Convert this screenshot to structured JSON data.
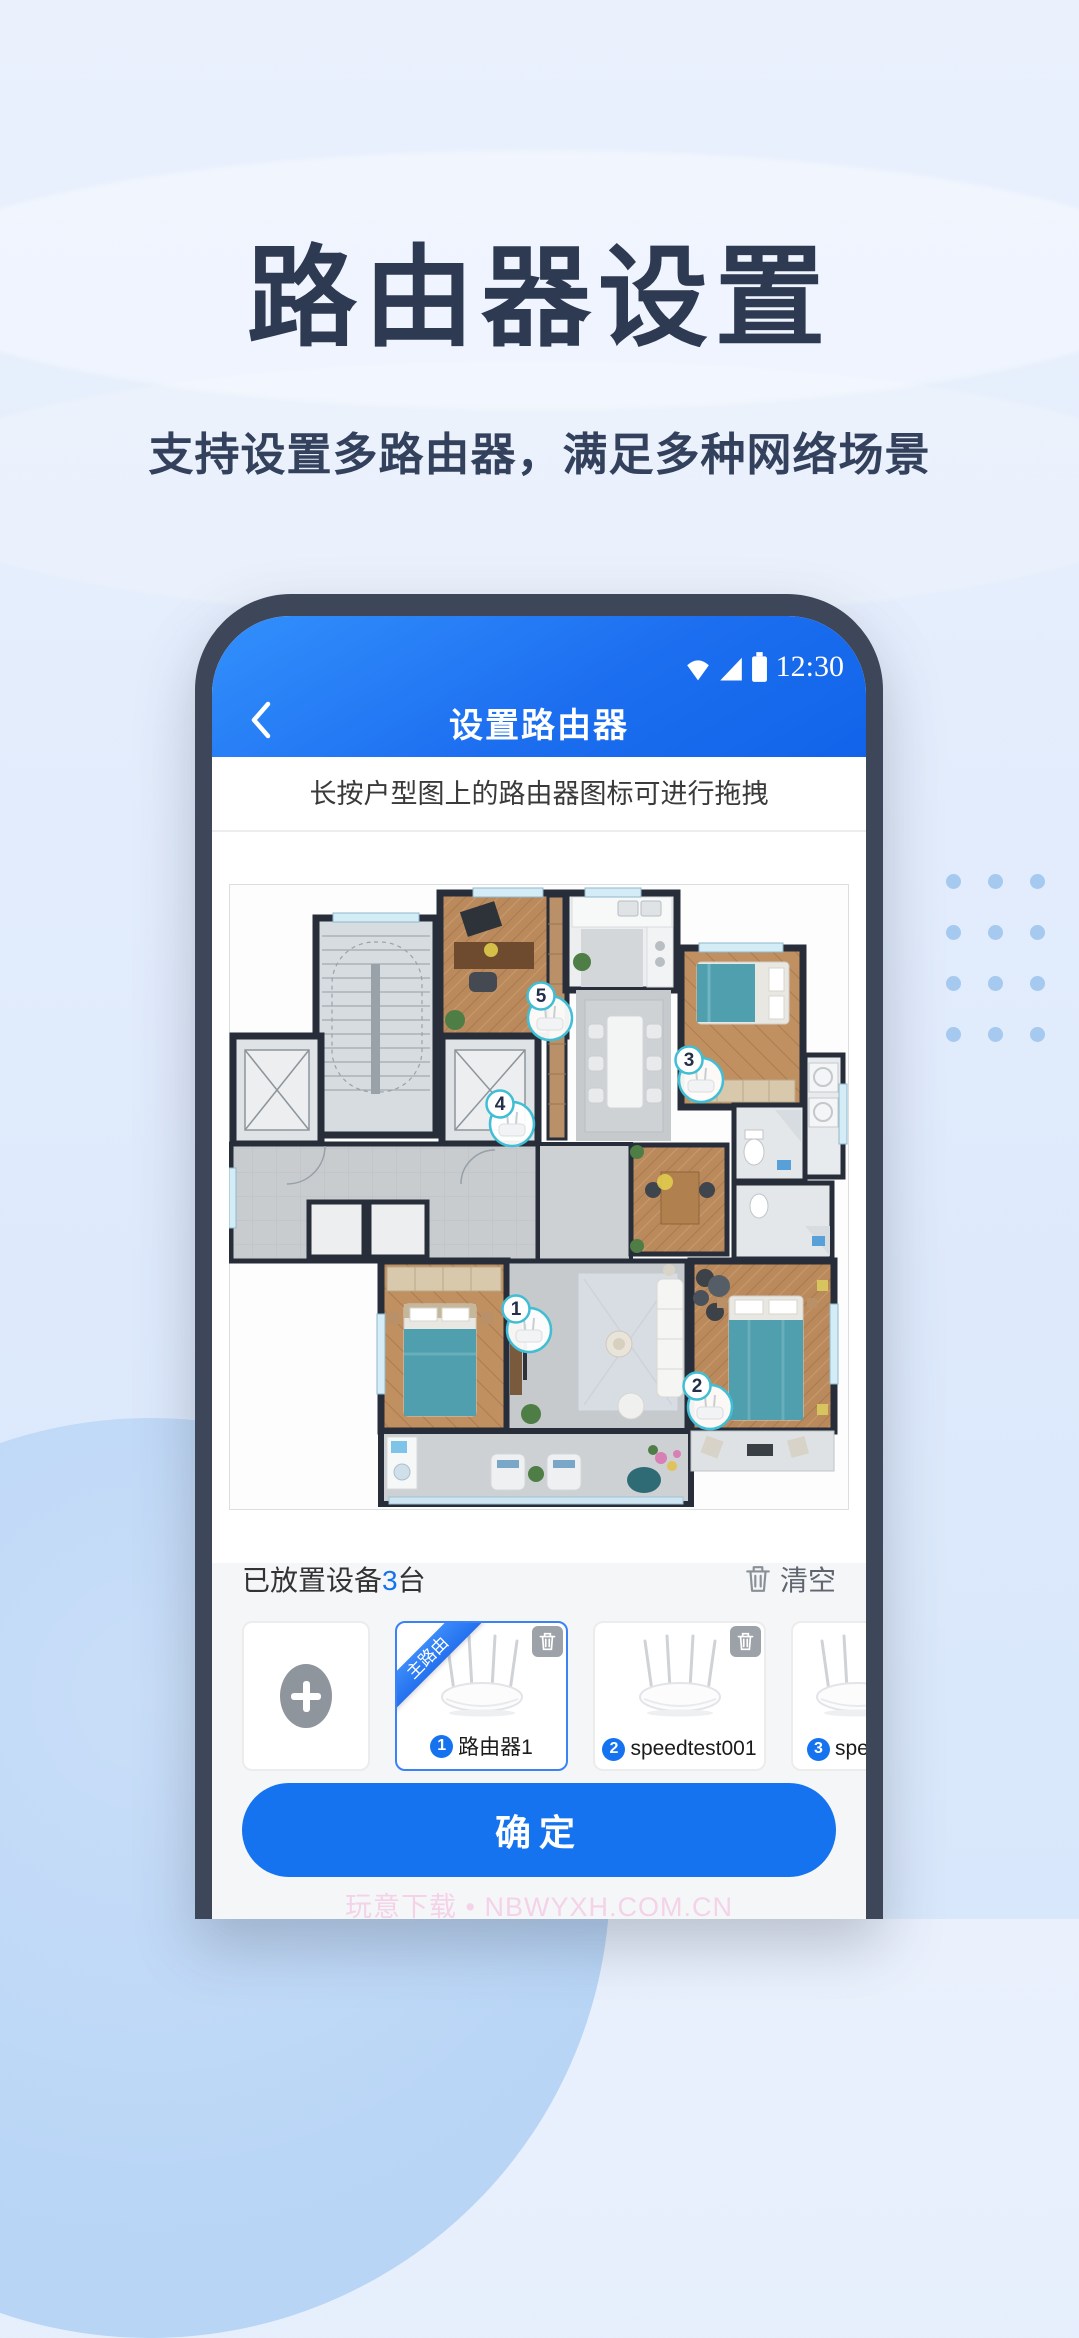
{
  "hero": {
    "title": "路由器设置",
    "subtitle": "支持设置多路由器，满足多种网络场景"
  },
  "phone": {
    "status_bar": {
      "time": "12:30",
      "icons": [
        "wifi-icon",
        "signal-icon",
        "battery-icon"
      ]
    },
    "nav_bar": {
      "title": "设置路由器",
      "back_icon": "chevron-left-icon"
    },
    "instruction": "长按户型图上的路由器图标可进行拖拽",
    "floor_plan": {
      "markers": [
        {
          "number": "1"
        },
        {
          "number": "2"
        },
        {
          "number": "3"
        },
        {
          "number": "4"
        },
        {
          "number": "5"
        }
      ]
    },
    "devices": {
      "placed_prefix": "已放置设备",
      "placed_count": "3",
      "placed_suffix": "台",
      "clear_label": "清空",
      "cards": [
        {
          "type": "add"
        },
        {
          "badge": "1",
          "name": "路由器1",
          "ribbon": "主路由",
          "selected": true
        },
        {
          "badge": "2",
          "name": "speedtest001"
        },
        {
          "badge": "3",
          "name": "spe"
        }
      ],
      "confirm_label": "确定"
    },
    "watermark": "玩意下载 • NBWYXH.COM.CN"
  },
  "colors": {
    "accent_blue": "#1673f0",
    "marker_teal": "#41bed4",
    "title_navy": "#2d3a52",
    "ribbon_blue": "#2f80f7",
    "dot_blue": "#a6c9f0"
  }
}
